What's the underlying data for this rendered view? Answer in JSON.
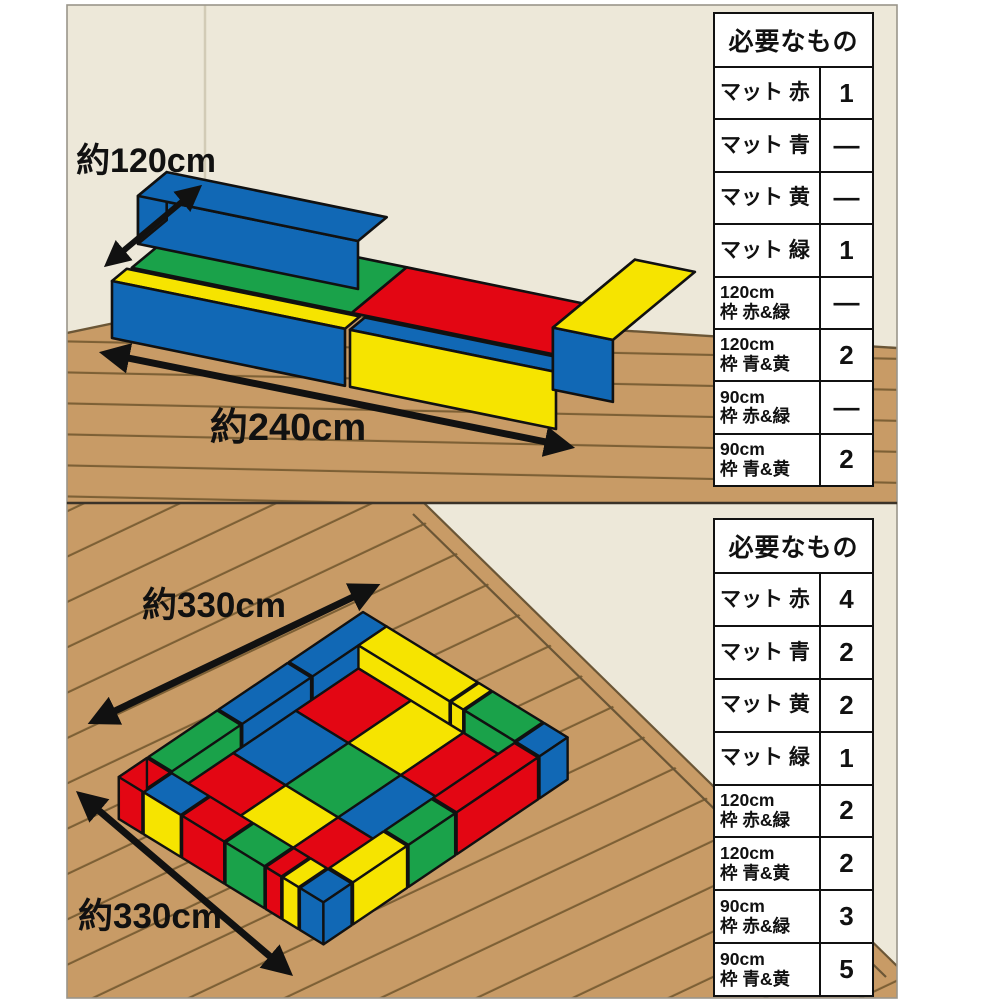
{
  "colors": {
    "red": "#E30613",
    "blue": "#1168B5",
    "green": "#1AA24A",
    "yellow": "#F6E400",
    "floor": "#C89B66",
    "plank_line": "#7D6035",
    "wall": "#EDE8D9",
    "outline": "#111111"
  },
  "top_panel": {
    "name": "bed-arrangement 120x240",
    "dim_width": "約120cm",
    "dim_length": "約240cm",
    "table": {
      "title": "必要なもの",
      "rows": [
        {
          "line1": "マット 赤",
          "qty": "1"
        },
        {
          "line1": "マット 青",
          "qty": "—"
        },
        {
          "line1": "マット 黄",
          "qty": "—"
        },
        {
          "line1": "マット 緑",
          "qty": "1"
        },
        {
          "line1": "120cm",
          "line2": "枠 赤&緑",
          "qty": "—"
        },
        {
          "line1": "120cm",
          "line2": "枠 青&黄",
          "qty": "2"
        },
        {
          "line1": "90cm",
          "line2": "枠 赤&緑",
          "qty": "—"
        },
        {
          "line1": "90cm",
          "line2": "枠 青&黄",
          "qty": "2"
        }
      ]
    }
  },
  "bottom_panel": {
    "name": "playpen-arrangement 330x330",
    "dim_side_top": "約330cm",
    "dim_side_left": "約330cm",
    "table": {
      "title": "必要なもの",
      "rows": [
        {
          "line1": "マット 赤",
          "qty": "4"
        },
        {
          "line1": "マット 青",
          "qty": "2"
        },
        {
          "line1": "マット 黄",
          "qty": "2"
        },
        {
          "line1": "マット 緑",
          "qty": "1"
        },
        {
          "line1": "120cm",
          "line2": "枠 赤&緑",
          "qty": "2"
        },
        {
          "line1": "120cm",
          "line2": "枠 青&黄",
          "qty": "2"
        },
        {
          "line1": "90cm",
          "line2": "枠 赤&緑",
          "qty": "3"
        },
        {
          "line1": "90cm",
          "line2": "枠 青&黄",
          "qty": "5"
        }
      ]
    }
  }
}
